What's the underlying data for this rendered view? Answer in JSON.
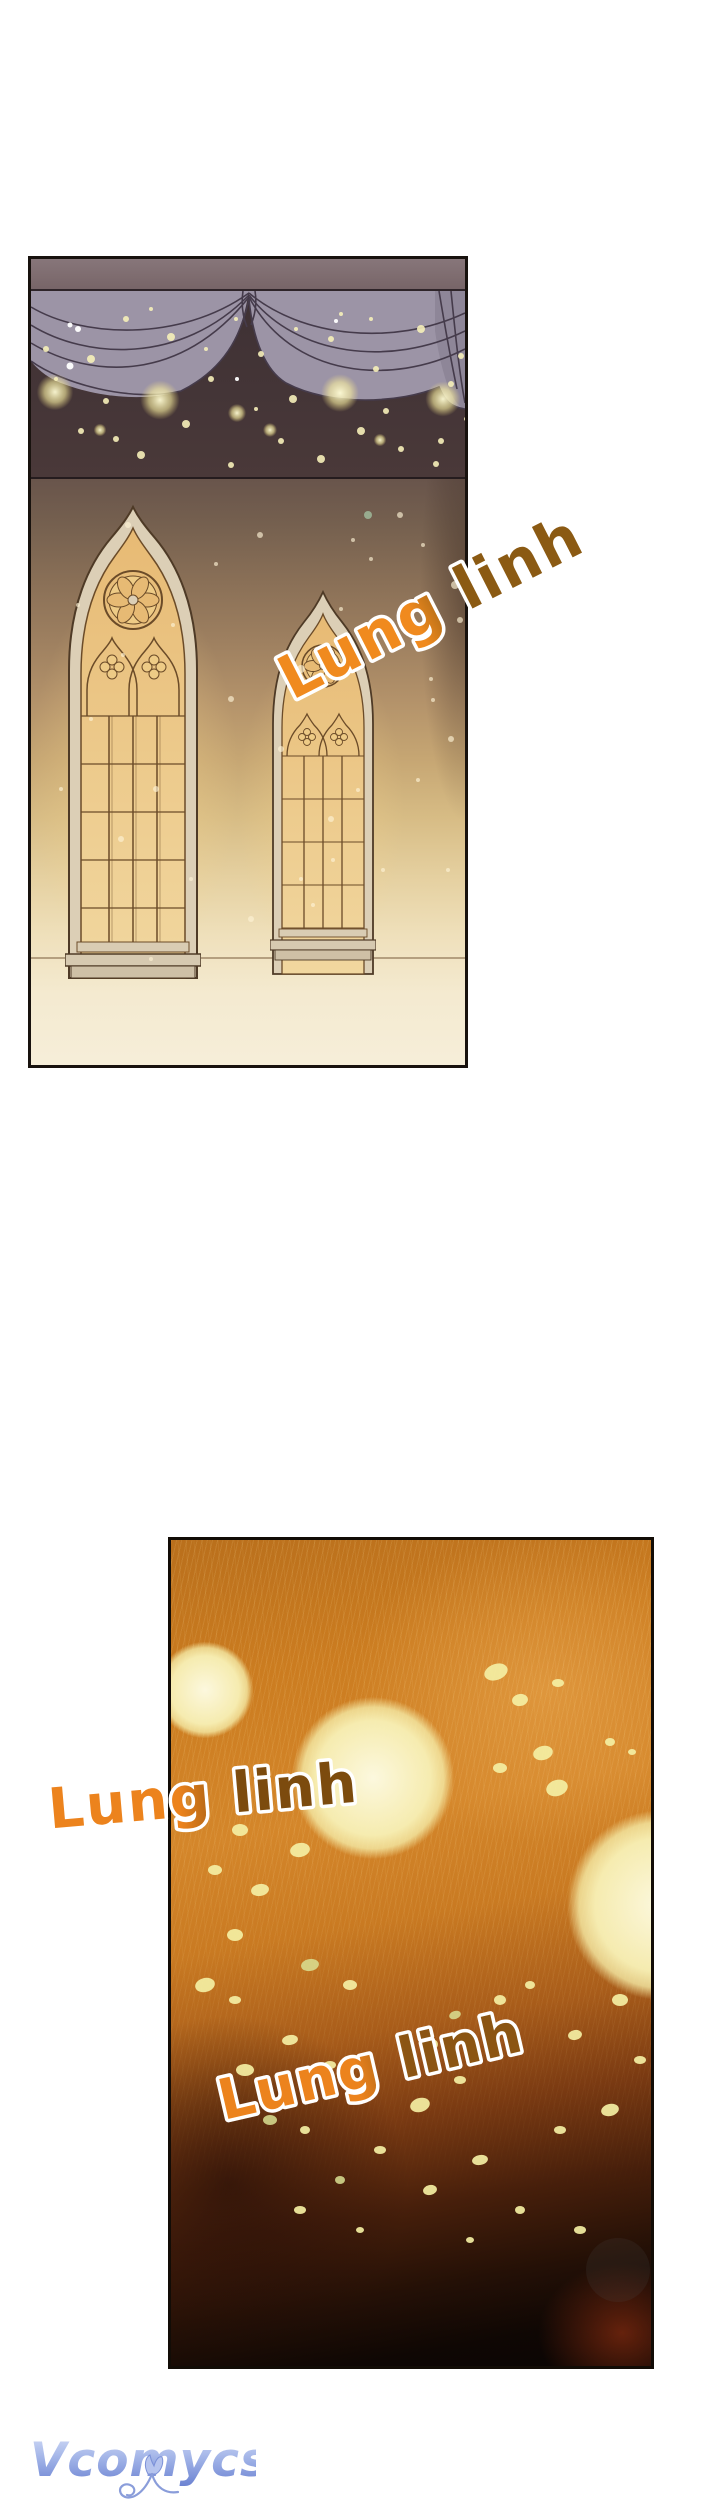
{
  "page": {
    "kind": "webtoon comic page",
    "background": "#ffffff"
  },
  "captions": [
    {
      "id": "caption-top-panel",
      "text": "Lung linh",
      "fill_start": "#F08A1E",
      "fill_end": "#8B5A13",
      "outline": "#ffffff",
      "rotation_deg": -27
    },
    {
      "id": "caption-bottom-panel-left",
      "text": "Lung linh",
      "fill_start": "#EC831D",
      "fill_end": "#7C4B0E",
      "outline": "#ffffff",
      "rotation_deg": -5
    },
    {
      "id": "caption-bottom-panel-inner",
      "text": "Lung linh",
      "fill_start": "#EC831D",
      "fill_end": "#8B5513",
      "outline": "#ffffff",
      "rotation_deg": -13
    }
  ],
  "watermark": {
    "text": "Vcomycs",
    "icon": "tulip-flower",
    "gradient_top": "#d3dcf7",
    "gradient_mid": "#9db0e6",
    "gradient_bottom": "#687fd0"
  },
  "panel_1": {
    "description": "palace hall: grey curtain valance with swags over dark band of golden bokeh, warm wall with two gothic stained-glass windows",
    "colors": {
      "valance": "#7E6C6F",
      "curtain": "#9C94A6",
      "curtain_line": "#453B4B",
      "dark_band": "#3E3134",
      "stone_frame": "#DCCFB6",
      "window_line": "#6B4B28",
      "glass_top": "#E7BA74",
      "glass_bottom": "#F1D79F",
      "sparkle_dot": "#F6EFB9",
      "wall_dot": "#FDF3D6",
      "teal_dot": "#9FB89A"
    },
    "artwork": {
      "glow_lights": [
        [
          24,
          133,
          26
        ],
        [
          129,
          141,
          28
        ],
        [
          206,
          154,
          13
        ],
        [
          309,
          134,
          27
        ],
        [
          412,
          140,
          25
        ],
        [
          69,
          171,
          9
        ],
        [
          239,
          171,
          10
        ],
        [
          349,
          181,
          9
        ]
      ],
      "band_dots": [
        [
          15,
          90,
          3
        ],
        [
          60,
          100,
          4
        ],
        [
          95,
          60,
          3
        ],
        [
          140,
          78,
          4
        ],
        [
          180,
          120,
          3
        ],
        [
          230,
          95,
          3
        ],
        [
          262,
          140,
          4
        ],
        [
          300,
          80,
          3
        ],
        [
          345,
          110,
          3
        ],
        [
          390,
          70,
          4
        ],
        [
          420,
          125,
          3
        ],
        [
          155,
          165,
          4
        ],
        [
          250,
          182,
          3
        ],
        [
          330,
          172,
          4
        ],
        [
          50,
          172,
          3
        ],
        [
          110,
          196,
          4
        ],
        [
          200,
          206,
          3
        ],
        [
          290,
          200,
          4
        ],
        [
          370,
          190,
          3
        ],
        [
          410,
          182,
          3
        ],
        [
          75,
          142,
          3
        ],
        [
          355,
          152,
          3
        ],
        [
          430,
          97,
          3
        ],
        [
          205,
          60,
          2
        ],
        [
          310,
          55,
          2
        ],
        [
          120,
          50,
          2
        ],
        [
          25,
          120,
          2
        ],
        [
          435,
          160,
          2
        ],
        [
          175,
          90,
          2
        ],
        [
          85,
          180,
          3
        ],
        [
          225,
          150,
          2
        ],
        [
          405,
          205,
          3
        ],
        [
          340,
          60,
          2
        ],
        [
          265,
          70,
          2
        ]
      ],
      "white_specks": [
        [
          39,
          66,
          2.5
        ],
        [
          47,
          70,
          3
        ],
        [
          39,
          107,
          3.5
        ],
        [
          206,
          120,
          2
        ],
        [
          305,
          62,
          2
        ]
      ],
      "wall_dots": [
        [
          97,
          266,
          3
        ],
        [
          185,
          305,
          2
        ],
        [
          229,
          276,
          3
        ],
        [
          310,
          350,
          2
        ],
        [
          340,
          300,
          2
        ],
        [
          270,
          410,
          4
        ],
        [
          200,
          440,
          3
        ],
        [
          250,
          490,
          3
        ],
        [
          125,
          530,
          3
        ],
        [
          90,
          580,
          3
        ],
        [
          160,
          620,
          2
        ],
        [
          220,
          660,
          3
        ],
        [
          120,
          700,
          2
        ],
        [
          300,
          560,
          3
        ],
        [
          270,
          620,
          2
        ],
        [
          420,
          480,
          3
        ],
        [
          60,
          460,
          2
        ],
        [
          400,
          420,
          2
        ],
        [
          30,
          530,
          2
        ],
        [
          322,
          281,
          2
        ],
        [
          392,
          286,
          2
        ],
        [
          424,
          326,
          4
        ],
        [
          429,
          361,
          3
        ],
        [
          402,
          441,
          2
        ],
        [
          387,
          521,
          2
        ],
        [
          327,
          531,
          2
        ],
        [
          282,
          646,
          2
        ],
        [
          352,
          611,
          2
        ],
        [
          302,
          601,
          2
        ],
        [
          417,
          611,
          2
        ],
        [
          92,
          396,
          2
        ],
        [
          47,
          346,
          2
        ],
        [
          142,
          366,
          2
        ],
        [
          369,
          256,
          3
        ]
      ],
      "teal_dots": [
        [
          337,
          256,
          4
        ]
      ]
    }
  },
  "panel_2": {
    "description": "amber close-up full of large glowing bokeh orbs and sparks, fading to darkness at the bottom with a faint red ember glow",
    "colors": {
      "dot": "#F4EFA3",
      "green_dot": "#D9E093",
      "orb_core": "#FCF8DE"
    },
    "artwork": {
      "orbs": [
        [
          34,
          150,
          62
        ],
        [
          202,
          238,
          104
        ],
        [
          491,
          365,
          122
        ]
      ],
      "dots": [
        [
          325,
          132,
          12,
          8,
          -20
        ],
        [
          349,
          160,
          8,
          6,
          -10
        ],
        [
          387,
          143,
          6,
          4,
          0
        ],
        [
          372,
          213,
          10,
          7,
          -15
        ],
        [
          329,
          228,
          7,
          5,
          0
        ],
        [
          386,
          248,
          11,
          8,
          -18
        ],
        [
          439,
          202,
          5,
          4,
          0
        ],
        [
          461,
          212,
          4,
          3,
          0
        ],
        [
          129,
          310,
          10,
          7,
          -12
        ],
        [
          69,
          290,
          8,
          6,
          0
        ],
        [
          44,
          330,
          7,
          5,
          0
        ],
        [
          89,
          350,
          9,
          6,
          -10
        ],
        [
          64,
          395,
          8,
          6,
          0
        ],
        [
          34,
          445,
          10,
          7,
          -14
        ],
        [
          64,
          460,
          6,
          4,
          0
        ],
        [
          179,
          445,
          7,
          5,
          0
        ],
        [
          119,
          500,
          8,
          5,
          -10
        ],
        [
          159,
          525,
          6,
          4,
          0
        ],
        [
          74,
          530,
          9,
          6,
          0
        ],
        [
          134,
          590,
          5,
          4,
          0
        ],
        [
          259,
          505,
          8,
          6,
          -12
        ],
        [
          289,
          540,
          6,
          4,
          0
        ],
        [
          249,
          565,
          10,
          7,
          -16
        ],
        [
          329,
          460,
          6,
          5,
          0
        ],
        [
          359,
          445,
          5,
          4,
          0
        ],
        [
          404,
          495,
          7,
          5,
          -10
        ],
        [
          449,
          460,
          8,
          6,
          0
        ],
        [
          469,
          520,
          6,
          4,
          0
        ],
        [
          439,
          570,
          9,
          6,
          -14
        ],
        [
          389,
          590,
          6,
          4,
          0
        ],
        [
          309,
          620,
          8,
          5,
          -10
        ],
        [
          209,
          610,
          6,
          4,
          0
        ],
        [
          129,
          670,
          6,
          4,
          0
        ],
        [
          259,
          650,
          7,
          5,
          -12
        ],
        [
          349,
          670,
          5,
          4,
          0
        ],
        [
          409,
          690,
          6,
          4,
          0
        ],
        [
          299,
          700,
          4,
          3,
          0
        ],
        [
          189,
          690,
          4,
          3,
          0
        ]
      ],
      "green_dots": [
        [
          139,
          425,
          9,
          6,
          -10
        ],
        [
          99,
          580,
          7,
          5,
          0
        ],
        [
          169,
          640,
          5,
          4,
          0
        ],
        [
          284,
          475,
          6,
          4,
          -20
        ]
      ],
      "ghost_circle": [
        447,
        730,
        32
      ]
    }
  }
}
